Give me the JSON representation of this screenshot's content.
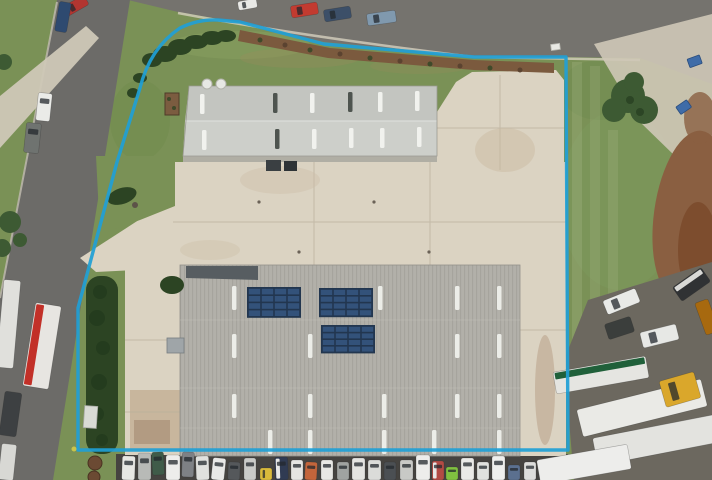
{
  "scene": {
    "type": "aerial-photo",
    "subject": "Drone aerial view of an industrial property with two grey warehouse buildings, concrete hardstand yard, hedges and lawns, outlined with a bright blue site-boundary overlay; streets with parked cars on the left and top, truck trailers parked bottom-right",
    "palette": {
      "grass": "#7a9156",
      "grass_dark": "#66834a",
      "grass_light": "#8ea765",
      "hedge": "#2c4423",
      "tree": "#3d5a33",
      "road_top": "#75736e",
      "road_left": "#6c6b68",
      "footpath": "#cfc8b7",
      "concrete": "#dbd3c2",
      "apron": "#c8b69d",
      "asphalt_dark": "#454340",
      "gravel": "#6c685f",
      "dirt": "#8a5f41",
      "mulch": "#7b5a3e",
      "roof_a_upper": "#c3c5c0",
      "roof_a_lower": "#cdcfca",
      "roof_b": "#b2b0a9",
      "roof_b_rib": "#a6a49d",
      "awning": "#575d61",
      "skylight_light": "#f1f2ee",
      "skylight_dark": "#4e544f",
      "solar_frame": "#22364f",
      "solar_cell": "#33527a",
      "boundary": "#1f9fd6"
    },
    "boundary": {
      "path": "M78,450 L78,308 L117,162 L140,88 Q150,48 180,28 Q198,19 218,20 L240,22 L324,44 L474,57 L566,57 L568,450 Z",
      "stroke_width": 3.4
    }
  },
  "buildings": {
    "north": {
      "skylights": [
        {
          "x": 200,
          "y": 94,
          "shade": "light"
        },
        {
          "x": 273,
          "y": 93,
          "shade": "dark"
        },
        {
          "x": 310,
          "y": 93,
          "shade": "light"
        },
        {
          "x": 348,
          "y": 92,
          "shade": "dark"
        },
        {
          "x": 378,
          "y": 92,
          "shade": "light"
        },
        {
          "x": 415,
          "y": 91,
          "shade": "light"
        },
        {
          "x": 202,
          "y": 130,
          "shade": "light"
        },
        {
          "x": 275,
          "y": 129,
          "shade": "dark"
        },
        {
          "x": 312,
          "y": 129,
          "shade": "light"
        },
        {
          "x": 349,
          "y": 128,
          "shade": "light"
        },
        {
          "x": 380,
          "y": 128,
          "shade": "light"
        },
        {
          "x": 417,
          "y": 127,
          "shade": "light"
        }
      ]
    },
    "south": {
      "solar_arrays": [
        {
          "x": 248,
          "y": 288,
          "cols": 4,
          "rows": 4,
          "cw": 13,
          "ch": 7.2
        },
        {
          "x": 320,
          "y": 289,
          "cols": 4,
          "rows": 4,
          "cw": 13,
          "ch": 6.8
        },
        {
          "x": 322,
          "y": 326,
          "cols": 4,
          "rows": 4,
          "cw": 13,
          "ch": 6.6
        }
      ],
      "skylights": [
        {
          "x": 232,
          "y": 286
        },
        {
          "x": 378,
          "y": 286
        },
        {
          "x": 455,
          "y": 286
        },
        {
          "x": 497,
          "y": 286
        },
        {
          "x": 232,
          "y": 334
        },
        {
          "x": 308,
          "y": 334
        },
        {
          "x": 455,
          "y": 334
        },
        {
          "x": 497,
          "y": 334
        },
        {
          "x": 232,
          "y": 394
        },
        {
          "x": 308,
          "y": 394
        },
        {
          "x": 382,
          "y": 394
        },
        {
          "x": 455,
          "y": 394
        },
        {
          "x": 497,
          "y": 394
        },
        {
          "x": 268,
          "y": 430
        },
        {
          "x": 308,
          "y": 430
        },
        {
          "x": 382,
          "y": 430
        },
        {
          "x": 432,
          "y": 430
        },
        {
          "x": 497,
          "y": 430
        }
      ]
    }
  },
  "vehicles": {
    "top_road": [
      {
        "x": 64,
        "y": 0,
        "w": 24,
        "h": 11,
        "r": -30,
        "c": "#b23530",
        "win": 1
      },
      {
        "x": 238,
        "y": 0,
        "w": 19,
        "h": 9,
        "r": -10,
        "c": "#e9e9e6",
        "win": 1
      },
      {
        "x": 291,
        "y": 4,
        "w": 27,
        "h": 12,
        "r": -9,
        "c": "#c23b30",
        "win": 1
      },
      {
        "x": 324,
        "y": 8,
        "w": 27,
        "h": 12,
        "r": -9,
        "c": "#3c4f68",
        "win": 1
      },
      {
        "x": 367,
        "y": 12,
        "w": 29,
        "h": 12,
        "r": -8,
        "c": "#8099ae",
        "win": 1
      }
    ],
    "left_road": [
      {
        "x": 37,
        "y": 93,
        "w": 14,
        "h": 28,
        "r": 6,
        "c": "#eaebe8",
        "win": 1
      },
      {
        "x": 25,
        "y": 123,
        "w": 15,
        "h": 30,
        "r": 6,
        "c": "#6f7370",
        "win": 1
      },
      {
        "x": 57,
        "y": 2,
        "w": 12,
        "h": 30,
        "r": 10,
        "c": "#2e4a70",
        "win": 0
      },
      {
        "x": 0,
        "y": 280,
        "w": 17,
        "h": 88,
        "r": 5,
        "c": "#e0e0dc",
        "win": 0
      },
      {
        "x": 29,
        "y": 304,
        "w": 26,
        "h": 84,
        "r": 9,
        "c": "#e7e5e1",
        "win": 0,
        "s": "#c23028"
      },
      {
        "x": 2,
        "y": 392,
        "w": 17,
        "h": 44,
        "r": 8,
        "c": "#3d4042",
        "win": 0
      },
      {
        "x": 0,
        "y": 444,
        "w": 15,
        "h": 36,
        "r": 6,
        "c": "#d8d8d4",
        "win": 0
      }
    ],
    "bottom_row": [
      {
        "x": 122,
        "y": 456,
        "w": 13,
        "h": 24,
        "r": 2,
        "c": "#e7e7e3",
        "win": 1
      },
      {
        "x": 138,
        "y": 453,
        "w": 13,
        "h": 27,
        "r": 0,
        "c": "#b8bab7",
        "win": 1
      },
      {
        "x": 152,
        "y": 452,
        "w": 12,
        "h": 23,
        "r": -3,
        "c": "#3f5b49",
        "win": 1
      },
      {
        "x": 166,
        "y": 455,
        "w": 14,
        "h": 25,
        "r": 0,
        "c": "#ededeb",
        "win": 1
      },
      {
        "x": 182,
        "y": 452,
        "w": 12,
        "h": 25,
        "r": 2,
        "c": "#7e8185",
        "win": 1
      },
      {
        "x": 196,
        "y": 456,
        "w": 13,
        "h": 24,
        "r": -2,
        "c": "#e0e1de",
        "win": 1
      },
      {
        "x": 212,
        "y": 458,
        "w": 13,
        "h": 22,
        "r": 6,
        "c": "#e9e9e7",
        "win": 1
      },
      {
        "x": 228,
        "y": 462,
        "w": 12,
        "h": 18,
        "r": 2,
        "c": "#55585b",
        "win": 1
      },
      {
        "x": 244,
        "y": 458,
        "w": 12,
        "h": 22,
        "r": 0,
        "c": "#cacbc8",
        "win": 1
      },
      {
        "x": 260,
        "y": 468,
        "w": 12,
        "h": 12,
        "r": 0,
        "c": "#d9ba3b",
        "win": 1
      },
      {
        "x": 275,
        "y": 457,
        "w": 13,
        "h": 23,
        "r": -2,
        "c": "#303b53",
        "win": 1,
        "s": "#e9e9e7"
      },
      {
        "x": 291,
        "y": 460,
        "w": 12,
        "h": 20,
        "r": 0,
        "c": "#e5e5e2",
        "win": 1
      },
      {
        "x": 305,
        "y": 462,
        "w": 12,
        "h": 18,
        "r": 3,
        "c": "#c3653b",
        "win": 1
      },
      {
        "x": 321,
        "y": 460,
        "w": 12,
        "h": 20,
        "r": 0,
        "c": "#e8e8e5",
        "win": 1
      },
      {
        "x": 337,
        "y": 462,
        "w": 12,
        "h": 18,
        "r": 0,
        "c": "#a0a3a1",
        "win": 1
      },
      {
        "x": 352,
        "y": 458,
        "w": 13,
        "h": 22,
        "r": 0,
        "c": "#e4e4e1",
        "win": 1
      },
      {
        "x": 368,
        "y": 460,
        "w": 13,
        "h": 20,
        "r": 0,
        "c": "#dbdcd9",
        "win": 1
      },
      {
        "x": 384,
        "y": 462,
        "w": 12,
        "h": 18,
        "r": 0,
        "c": "#4b4f53",
        "win": 1
      },
      {
        "x": 400,
        "y": 460,
        "w": 13,
        "h": 20,
        "r": 0,
        "c": "#c8c9c6",
        "win": 1
      },
      {
        "x": 416,
        "y": 455,
        "w": 14,
        "h": 25,
        "r": 0,
        "c": "#ededeb",
        "win": 1
      },
      {
        "x": 432,
        "y": 461,
        "w": 12,
        "h": 19,
        "r": 0,
        "c": "#b24b44",
        "win": 1,
        "s": "#e9e9e7"
      },
      {
        "x": 446,
        "y": 467,
        "w": 12,
        "h": 13,
        "r": 0,
        "c": "#80c040",
        "win": 1
      },
      {
        "x": 461,
        "y": 458,
        "w": 13,
        "h": 22,
        "r": 0,
        "c": "#eaeae7",
        "win": 1
      },
      {
        "x": 477,
        "y": 462,
        "w": 12,
        "h": 18,
        "r": 0,
        "c": "#e0e1de",
        "win": 1
      },
      {
        "x": 492,
        "y": 456,
        "w": 13,
        "h": 24,
        "r": 0,
        "c": "#efefed",
        "win": 1
      },
      {
        "x": 508,
        "y": 465,
        "w": 12,
        "h": 15,
        "r": 0,
        "c": "#5b708f",
        "win": 1
      },
      {
        "x": 524,
        "y": 462,
        "w": 12,
        "h": 18,
        "r": 0,
        "c": "#dddddb",
        "win": 1
      },
      {
        "x": 540,
        "y": 466,
        "w": 12,
        "h": 14,
        "r": 0,
        "c": "#47494c",
        "win": 1
      }
    ],
    "right_yard": [
      {
        "x": 604,
        "y": 294,
        "w": 35,
        "h": 15,
        "r": -22,
        "c": "#e9eae7",
        "win": 1
      },
      {
        "x": 606,
        "y": 320,
        "w": 27,
        "h": 16,
        "r": -18,
        "c": "#3b3e3c",
        "win": 0
      },
      {
        "x": 641,
        "y": 328,
        "w": 37,
        "h": 16,
        "r": -14,
        "c": "#e7e8e5",
        "win": 1
      },
      {
        "x": 674,
        "y": 276,
        "w": 35,
        "h": 17,
        "r": -35,
        "c": "#303234",
        "win": 0,
        "s": "#d9d9d6"
      },
      {
        "x": 554,
        "y": 364,
        "w": 94,
        "h": 22,
        "r": -10,
        "c": "#e5e5e1",
        "win": 0,
        "s": "#20603a"
      },
      {
        "x": 578,
        "y": 394,
        "w": 128,
        "h": 28,
        "r": -14,
        "c": "#eaeae6",
        "win": 0
      },
      {
        "x": 594,
        "y": 426,
        "w": 126,
        "h": 28,
        "r": -11,
        "c": "#e3e3df",
        "win": 0
      },
      {
        "x": 538,
        "y": 452,
        "w": 92,
        "h": 25,
        "r": -10,
        "c": "#ededeb",
        "win": 0
      },
      {
        "x": 662,
        "y": 376,
        "w": 36,
        "h": 27,
        "r": -16,
        "c": "#daa72b",
        "win": 1
      },
      {
        "x": 700,
        "y": 300,
        "w": 14,
        "h": 34,
        "r": -20,
        "c": "#a7690f",
        "win": 0
      }
    ]
  }
}
